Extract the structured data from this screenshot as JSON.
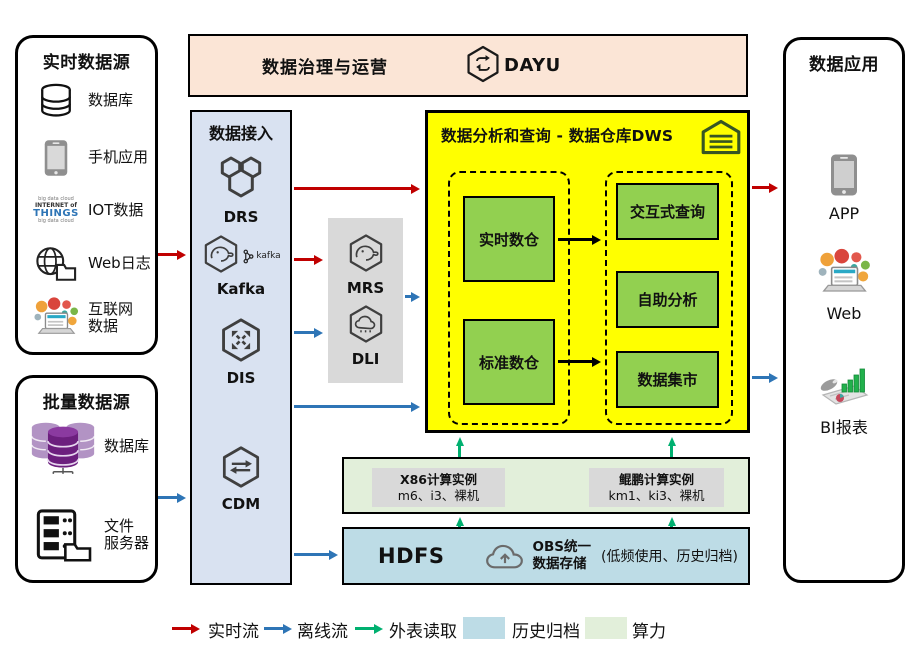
{
  "top_bar": {
    "title": "数据治理与运营",
    "product": "DAYU"
  },
  "realtime_sources": {
    "title": "实时数据源",
    "items": [
      {
        "line1": "数据库"
      },
      {
        "line1": "手机应用"
      },
      {
        "line1": "IOT数据"
      },
      {
        "line1": "Web日志"
      },
      {
        "line1": "互联网",
        "line2": "数据"
      }
    ],
    "iot_words": {
      "w1": "big data cloud",
      "w2": "INTERNET of",
      "w3": "THINGS"
    }
  },
  "batch_sources": {
    "title": "批量数据源",
    "items": [
      {
        "line1": "数据库"
      },
      {
        "line1": "文件",
        "line2": "服务器"
      }
    ]
  },
  "ingest": {
    "title": "数据接入",
    "services": [
      "DRS",
      "Kafka",
      "DIS",
      "CDM"
    ],
    "kafka_badge": "kafka"
  },
  "processing": {
    "services": [
      "MRS",
      "DLI"
    ]
  },
  "dws": {
    "title": "数据分析和查询 - 数据仓库DWS",
    "warehouses": [
      "实时数仓",
      "标准数仓"
    ],
    "services": [
      "交互式查询",
      "自助分析",
      "数据集市"
    ]
  },
  "compute": {
    "x86_title": "X86计算实例",
    "x86_sub": "m6、i3、裸机",
    "kunpeng_title": "鲲鹏计算实例",
    "kunpeng_sub": "km1、ki3、裸机"
  },
  "storage": {
    "hdfs": "HDFS",
    "obs_line1": "OBS统一",
    "obs_line2": "数据存储",
    "note": "(低频使用、历史归档)"
  },
  "apps": {
    "title": "数据应用",
    "items": [
      "APP",
      "Web",
      "BI报表"
    ]
  },
  "legend": {
    "realtime": "实时流",
    "offline": "离线流",
    "external": "外表读取",
    "archive": "历史归档",
    "compute": "算力"
  },
  "colors": {
    "realtime_flow": "#C00000",
    "offline_flow": "#2E75B6",
    "external_read": "#00B070",
    "archive_bg": "#BDDCE6",
    "compute_bg": "#E2EFDA",
    "dws_bg": "#FFFF00",
    "warehouse_green": "#92D050",
    "governance_bg": "#FBE5D6",
    "ingest_bg": "#D9E2F1"
  }
}
